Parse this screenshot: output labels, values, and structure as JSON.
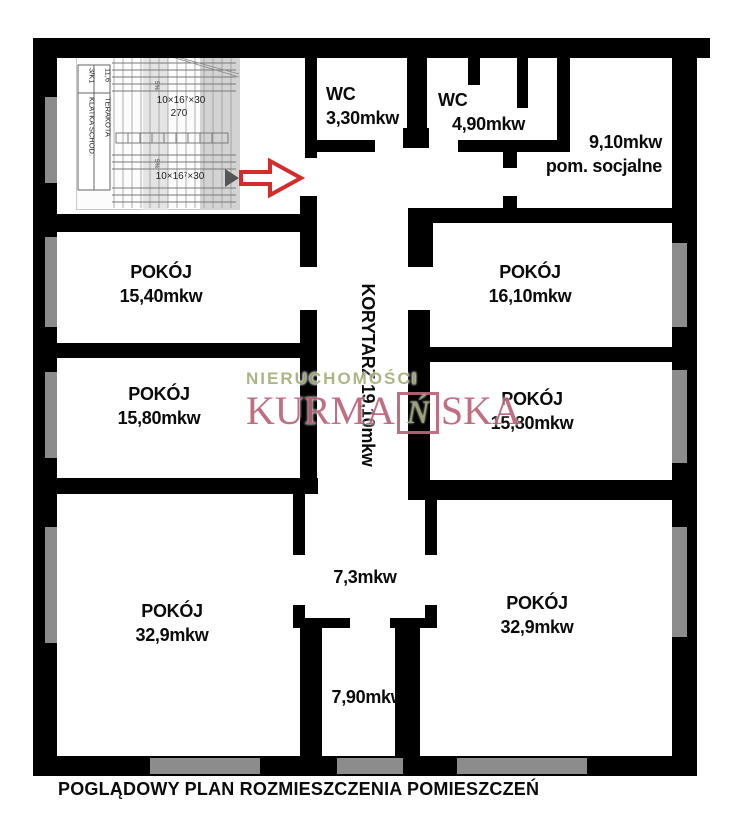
{
  "caption": "POGLĄDOWY PLAN ROZMIESZCZENIA POMIESZCZEŃ",
  "rooms": {
    "wc_small": {
      "name": "WC",
      "area": "3,30mkw"
    },
    "wc_large": {
      "name": "WC",
      "area": "4,90mkw"
    },
    "social": {
      "area": "9,10mkw",
      "name": "pom. socjalne"
    },
    "room_1540": {
      "name": "POKÓJ",
      "area": "15,40mkw"
    },
    "room_1610": {
      "name": "POKÓJ",
      "area": "16,10mkw"
    },
    "room_1580_left": {
      "name": "POKÓJ",
      "area": "15,80mkw"
    },
    "room_1580_right": {
      "name": "POKÓJ",
      "area": "15,80mkw"
    },
    "corridor": {
      "label": "KORYTARZ 19,10mkw"
    },
    "hall_73": {
      "area": "7,3mkw"
    },
    "hall_790": {
      "area": "7,90mkw"
    },
    "room_329_left": {
      "name": "POKÓJ",
      "area": "32,9mkw"
    },
    "room_329_right": {
      "name": "POKÓJ",
      "area": "32,9mkw"
    }
  },
  "staircase_inset": {
    "room_number": "3/K1",
    "room_name": "KLATKA SCHOD.",
    "room_area": "11,6",
    "floor_material": "TERAKOTA",
    "stair_note_upper": "10×16⁷×30",
    "stair_run_width": "270",
    "stair_note_lower": "10×16⁷×30",
    "slope_mark": "5%"
  },
  "watermark": {
    "line1": "NIERUCHOMOŚCI",
    "brand_prefix": "KURMA",
    "brand_boxed_letter": "Ń",
    "brand_suffix": "SKA"
  },
  "colors": {
    "wall": "#000000",
    "window": "#8c8c8c",
    "arrow": "#d42b2b",
    "watermark_green": "#a6b17c",
    "watermark_rose": "#bc6479"
  }
}
